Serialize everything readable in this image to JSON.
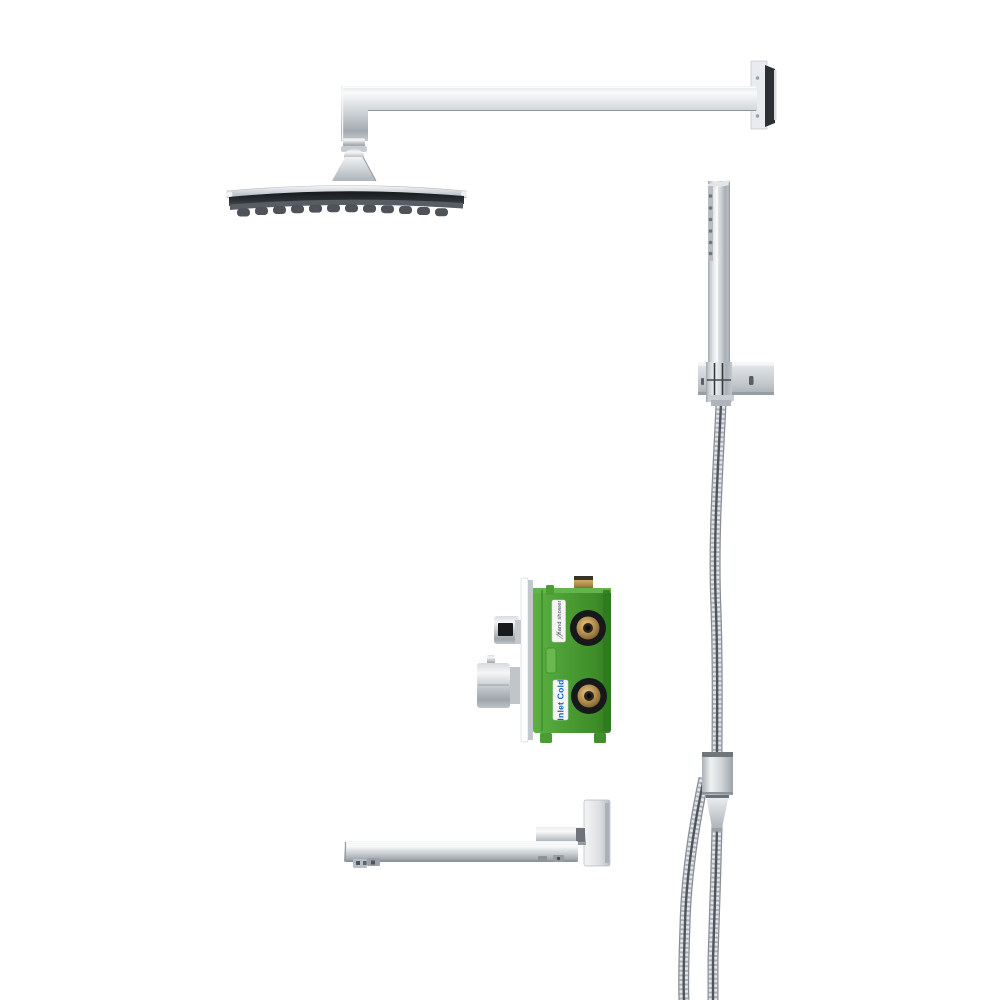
{
  "image": {
    "background_color": "#ffffff"
  },
  "labels": {
    "valve_top_label": "hand shower",
    "valve_bottom_label": "Inlet Cold"
  },
  "colors": {
    "chrome_light": "#f5f6f7",
    "chrome_mid": "#c7cbd0",
    "chrome_dark": "#8f959b",
    "shower_face_dark": "#26292c",
    "valve_green": "#4a9c33",
    "valve_green_dark": "#2f7a1f",
    "brass": "#b9954f",
    "port_seal_black": "#17181a",
    "label_blue_text": "#1763c6",
    "label_background": "#f3f5f2"
  },
  "parts": [
    "rain-shower-head",
    "shower-arm",
    "shower-arm-wall-flange",
    "handheld-shower-wand",
    "handheld-wall-bracket",
    "shower-hose",
    "hose-connector-fitting",
    "rough-in-valve-box",
    "valve-trim-plate",
    "valve-diverter-knob",
    "valve-mixer-knob",
    "valve-inlet-ports",
    "tub-spout",
    "tub-spout-wall-plate"
  ]
}
